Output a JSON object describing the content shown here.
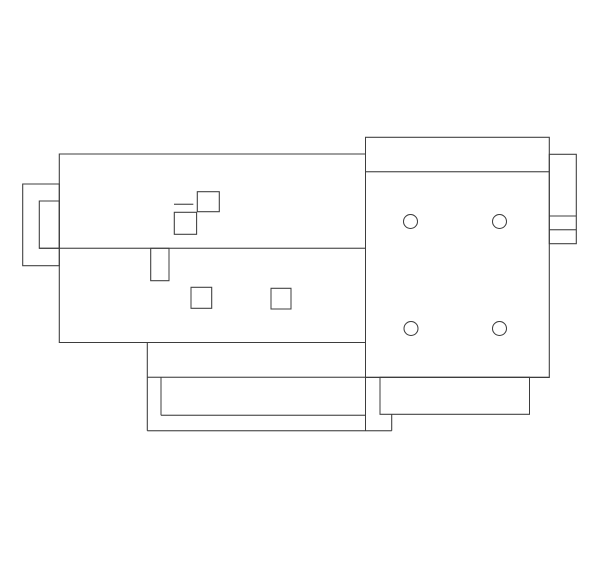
{
  "canvas": {
    "width": 600,
    "height": 569,
    "background": "#ffffff",
    "line_color": "#3d3d3d",
    "stroke_width": 1
  },
  "drawing": {
    "kind": "cad-line-drawing",
    "rects": [
      {
        "name": "left-mount-bracket-outer",
        "x": 22.7,
        "y": 184.0,
        "w": 36.6,
        "h": 81.7
      },
      {
        "name": "left-mount-bracket-inner",
        "x": 39.3,
        "y": 201.0,
        "w": 20.0,
        "h": 47.3
      },
      {
        "name": "main-housing-body",
        "x": 59.3,
        "y": 154.0,
        "w": 306.2,
        "h": 188.5
      },
      {
        "name": "component-square-upper",
        "x": 197.3,
        "y": 191.7,
        "w": 22.0,
        "h": 20.0
      },
      {
        "name": "component-square-mid",
        "x": 174.3,
        "y": 212.3,
        "w": 22.3,
        "h": 22.0
      },
      {
        "name": "divider-notch-rect",
        "x": 150.7,
        "y": 248.3,
        "w": 18.3,
        "h": 32.4
      },
      {
        "name": "lower-square-left",
        "x": 191.0,
        "y": 287.3,
        "w": 20.7,
        "h": 21.0
      },
      {
        "name": "lower-square-right",
        "x": 271.0,
        "y": 288.3,
        "w": 20.0,
        "h": 20.7
      },
      {
        "name": "right-end-panel",
        "x": 365.5,
        "y": 137.3,
        "w": 183.8,
        "h": 240.2
      },
      {
        "name": "right-side-flange",
        "x": 549.3,
        "y": 154.3,
        "w": 27.0,
        "h": 89.4
      },
      {
        "name": "base-plate-right-rect",
        "x": 380.0,
        "y": 377.3,
        "w": 149.5,
        "h": 37.0
      }
    ],
    "lines": [
      {
        "name": "body-divider-line",
        "x1": 39.3,
        "y1": 248.3,
        "x2": 365.5,
        "y2": 248.3
      },
      {
        "name": "component-tick-line",
        "x1": 174.0,
        "y1": 204.3,
        "x2": 193.3,
        "y2": 204.3
      },
      {
        "name": "panel-header-line",
        "x1": 365.5,
        "y1": 171.7,
        "x2": 549.3,
        "y2": 171.7
      },
      {
        "name": "flange-upper-line",
        "x1": 549.3,
        "y1": 216.0,
        "x2": 576.3,
        "y2": 216.0
      },
      {
        "name": "flange-lower-line",
        "x1": 549.3,
        "y1": 229.7,
        "x2": 576.3,
        "y2": 229.7
      },
      {
        "name": "base-left-edge",
        "x1": 147.3,
        "y1": 342.5,
        "x2": 147.3,
        "y2": 430.7
      },
      {
        "name": "base-top-line",
        "x1": 147.3,
        "y1": 377.3,
        "x2": 549.3,
        "y2": 377.3
      },
      {
        "name": "base-inner-left-edge",
        "x1": 161.0,
        "y1": 377.3,
        "x2": 161.0,
        "y2": 415.3
      },
      {
        "name": "base-inner-bottom-line",
        "x1": 161.0,
        "y1": 415.3,
        "x2": 365.5,
        "y2": 415.3
      },
      {
        "name": "panel-left-lower-edge",
        "x1": 365.5,
        "y1": 377.5,
        "x2": 365.5,
        "y2": 430.7
      },
      {
        "name": "base-bottom-line",
        "x1": 147.3,
        "y1": 430.7,
        "x2": 391.7,
        "y2": 430.7
      },
      {
        "name": "base-step-edge",
        "x1": 391.7,
        "y1": 414.3,
        "x2": 391.7,
        "y2": 430.7
      }
    ],
    "circles": [
      {
        "name": "bolt-hole-top-left",
        "cx": 410.5,
        "cy": 221.5,
        "r": 7
      },
      {
        "name": "bolt-hole-top-right",
        "cx": 499.5,
        "cy": 221.5,
        "r": 7
      },
      {
        "name": "bolt-hole-bottom-left",
        "cx": 411.0,
        "cy": 328.5,
        "r": 7
      },
      {
        "name": "bolt-hole-bottom-right",
        "cx": 499.5,
        "cy": 328.5,
        "r": 7
      }
    ]
  }
}
